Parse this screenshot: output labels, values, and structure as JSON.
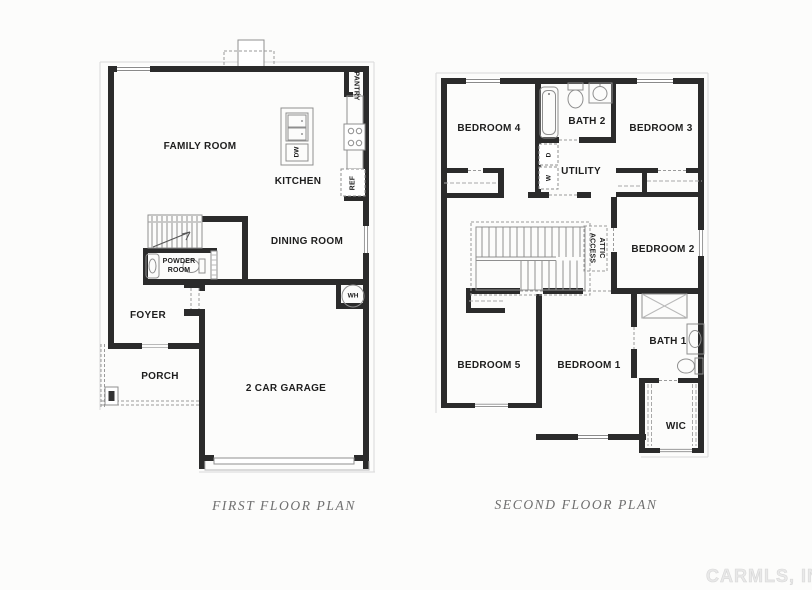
{
  "first_floor": {
    "title": "FIRST FLOOR PLAN",
    "labels": {
      "family_room": "FAMILY ROOM",
      "kitchen": "KITCHEN",
      "pantry": "PANTRY",
      "dw": "DW",
      "ref": "REF",
      "dining_room": "DINING ROOM",
      "powder_room_line1": "POWDER",
      "powder_room_line2": "ROOM",
      "foyer": "FOYER",
      "porch": "PORCH",
      "garage": "2 CAR GARAGE",
      "water_heater": "WH"
    }
  },
  "second_floor": {
    "title": "SECOND FLOOR PLAN",
    "labels": {
      "bedroom_4": "BEDROOM 4",
      "bath_2": "BATH 2",
      "bedroom_3": "BEDROOM 3",
      "utility": "UTILITY",
      "dryer": "D",
      "washer": "W",
      "attic_line1": "ATTIC",
      "attic_line2": "ACCESS",
      "bedroom_2": "BEDROOM 2",
      "bedroom_5": "BEDROOM 5",
      "bedroom_1": "BEDROOM 1",
      "bath_1": "BATH 1",
      "wic": "WIC"
    }
  },
  "watermark": {
    "text": "CARMLS, INC"
  },
  "colors": {
    "wall": "#2b2b2b",
    "fixture_line": "#8f8f8f",
    "title_text": "#6f6f6f",
    "watermark_text": "#e9e9e9",
    "background": "#fcfcfb"
  }
}
